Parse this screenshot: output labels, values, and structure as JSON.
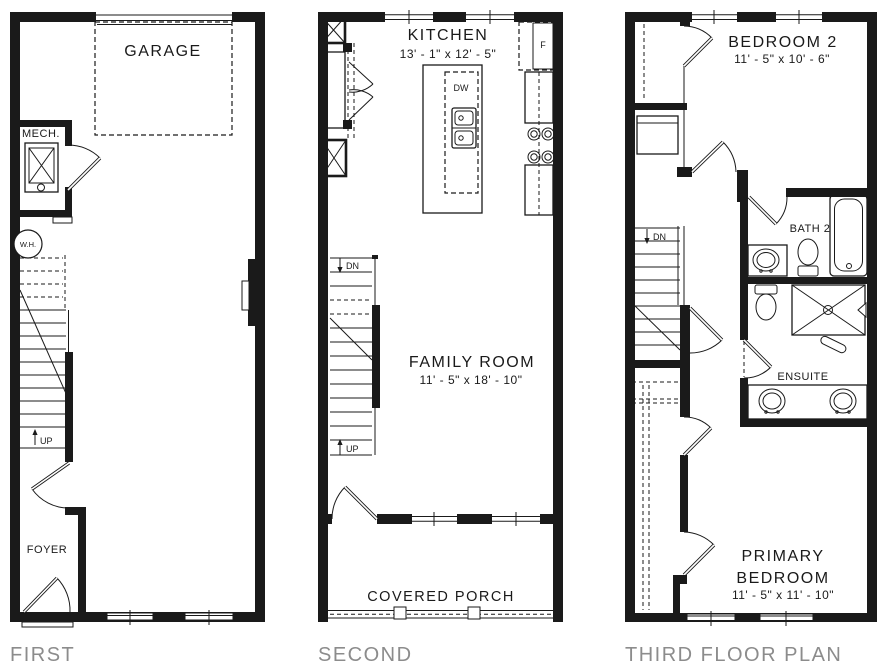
{
  "colors": {
    "line": "#1a1a1a",
    "floor_label": "#8c8c8c",
    "background": "#ffffff"
  },
  "plans": {
    "first": {
      "label": "FIRST",
      "garage": "GARAGE",
      "mech": "MECH.",
      "water_heater": "W.H.",
      "stairs_up": "UP",
      "foyer": "FOYER"
    },
    "second": {
      "label": "SECOND",
      "kitchen": "KITCHEN",
      "kitchen_dims": "13' - 1\" x 12' - 5\"",
      "dishwasher": "DW",
      "fridge": "F",
      "stairs_down": "DN",
      "stairs_up": "UP",
      "family_room": "FAMILY ROOM",
      "family_room_dims": "11' - 5\" x 18' - 10\"",
      "covered_porch": "COVERED PORCH"
    },
    "third": {
      "label": "THIRD FLOOR PLAN",
      "bedroom2": "BEDROOM 2",
      "bedroom2_dims": "11' - 5\" x 10' - 6\"",
      "bath2": "BATH 2",
      "stairs_down": "DN",
      "ensuite": "ENSUITE",
      "primary_line1": "PRIMARY",
      "primary_line2": "BEDROOM",
      "primary_dims": "11' - 5\" x 11' - 10\""
    }
  }
}
